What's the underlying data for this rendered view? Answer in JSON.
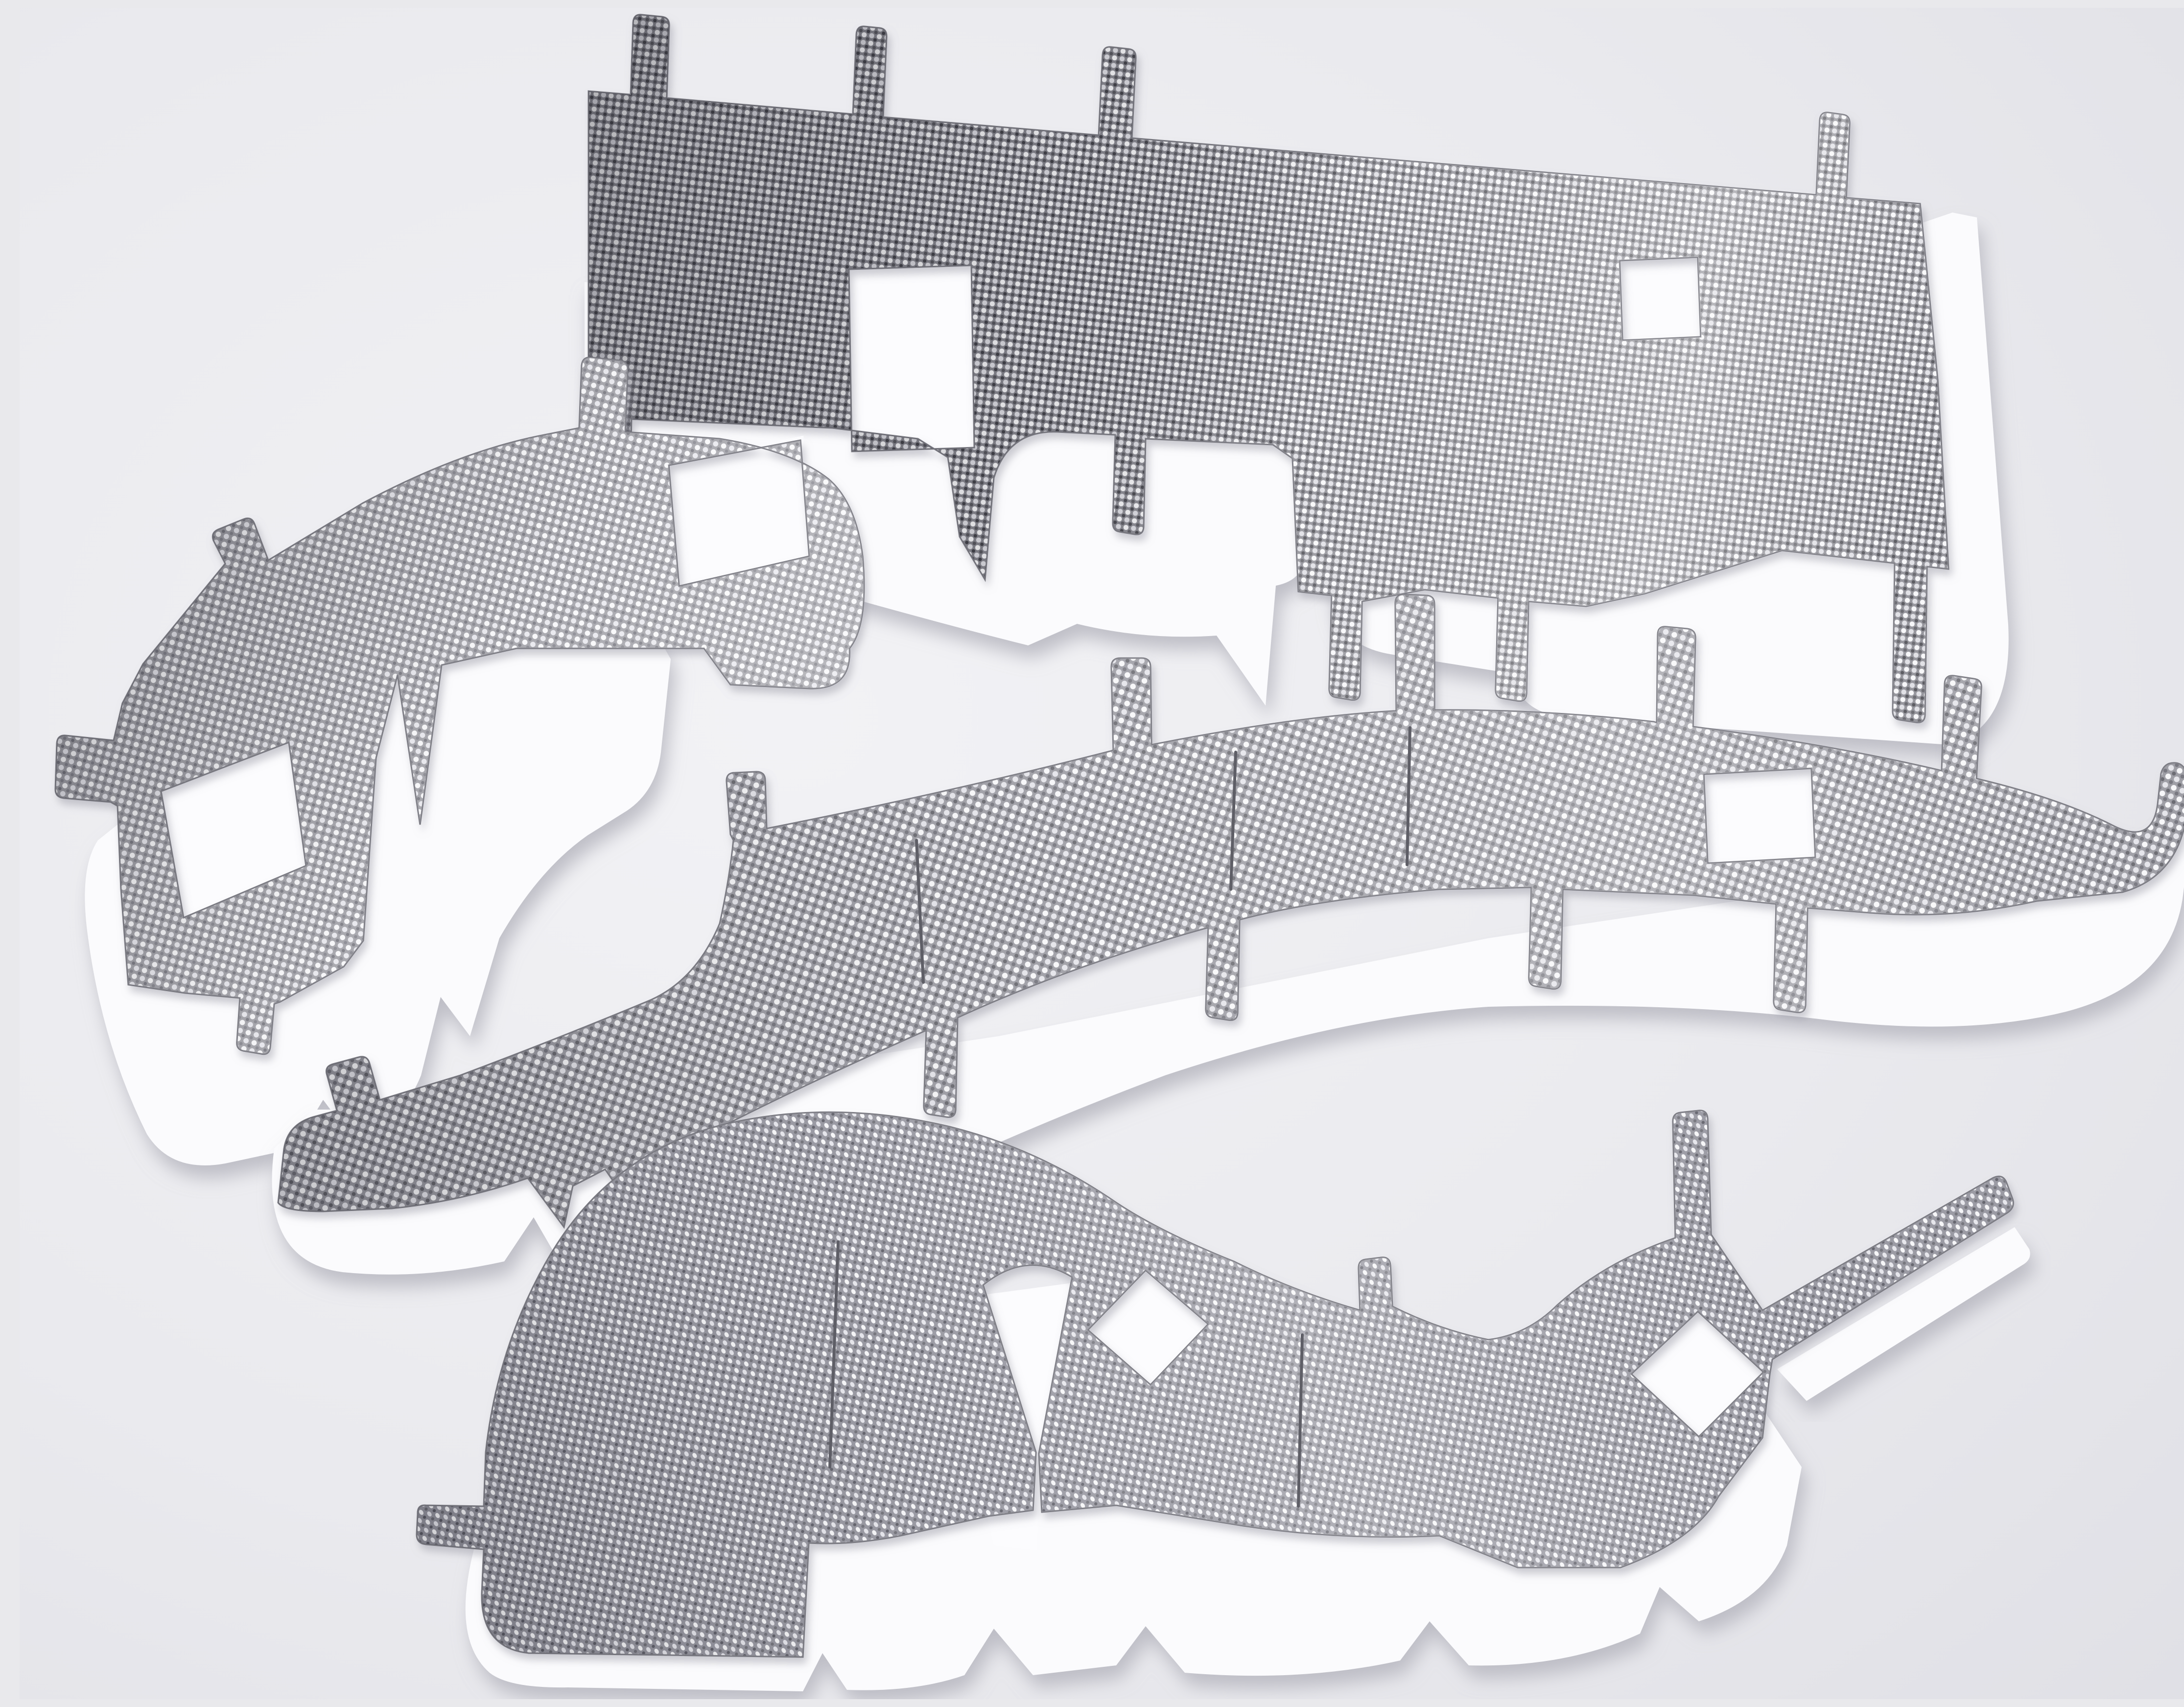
{
  "image": {
    "type": "product-photograph",
    "subject": "Four stamped embossed-aluminum heat shield insulation panels with white nonwoven felt backing laid on a light gray studio background",
    "background_color": "#e9e9ec",
    "piece_count": 4,
    "pieces": [
      {
        "name": "top-panel",
        "label": "Large upper heat shield panel with four upper mounting tabs, five lower tabs, one large and one small rectangular cutout, white felt liner showing along lower edge",
        "tabs_upper": 4,
        "tabs_lower": 5,
        "cutouts": 2
      },
      {
        "name": "left-bracket",
        "label": "Left curved heat shield bracket with angled left tab, two upper tabs, two rectangular cutouts and zigzag lower edge over white felt",
        "tabs": 5,
        "cutouts": 2
      },
      {
        "name": "center-band",
        "label": "Long S-curved central heat shield band with five upper tabs, four lower tabs, one rectangular cutout, expansion slits and hooked right end",
        "tabs_upper": 5,
        "tabs_lower": 4,
        "cutouts": 1,
        "slits": 3
      },
      {
        "name": "bottom-arch",
        "label": "Bottom arched heat shield piece with left tab, two diamond cutouts, inner V notch, angled right arm tab and fringed felt lower edge",
        "tabs": 4,
        "cutouts": 2,
        "slits": 2
      }
    ],
    "palette": {
      "background": "#e9e9ec",
      "foil_mid": "#8f8f96",
      "foil_highlight": "#f5f5f7",
      "foil_shadow": "#46464e",
      "felt": "#fbfbfd",
      "cut_edge": "#77777f",
      "cast_shadow": "#b9b9c2"
    }
  }
}
